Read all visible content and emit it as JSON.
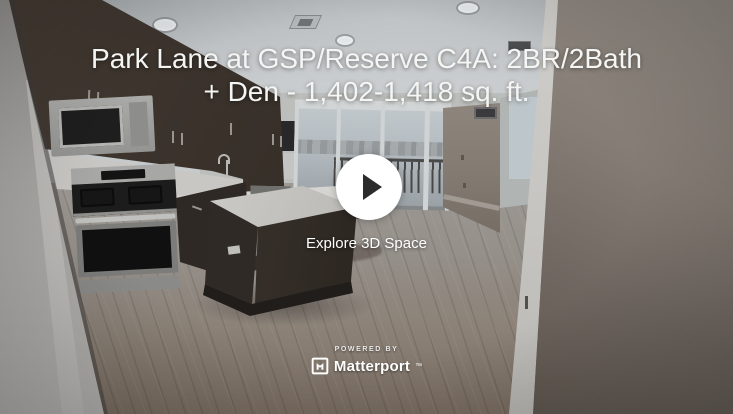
{
  "embed": {
    "title_line1": "Park Lane at GSP/Reserve C4A: 2BR/2Bath",
    "title_line2": "+ Den - 1,402-1,418 sq. ft.",
    "explore_label": "Explore 3D Space",
    "powered_by_label": "POWERED BY",
    "brand_name": "Matterport",
    "brand_trademark": "™",
    "colors": {
      "title_text": "#f5f5f4",
      "play_button_bg": "#ffffff",
      "play_triangle": "#2c2c2c",
      "brand_text": "#ffffff"
    }
  }
}
